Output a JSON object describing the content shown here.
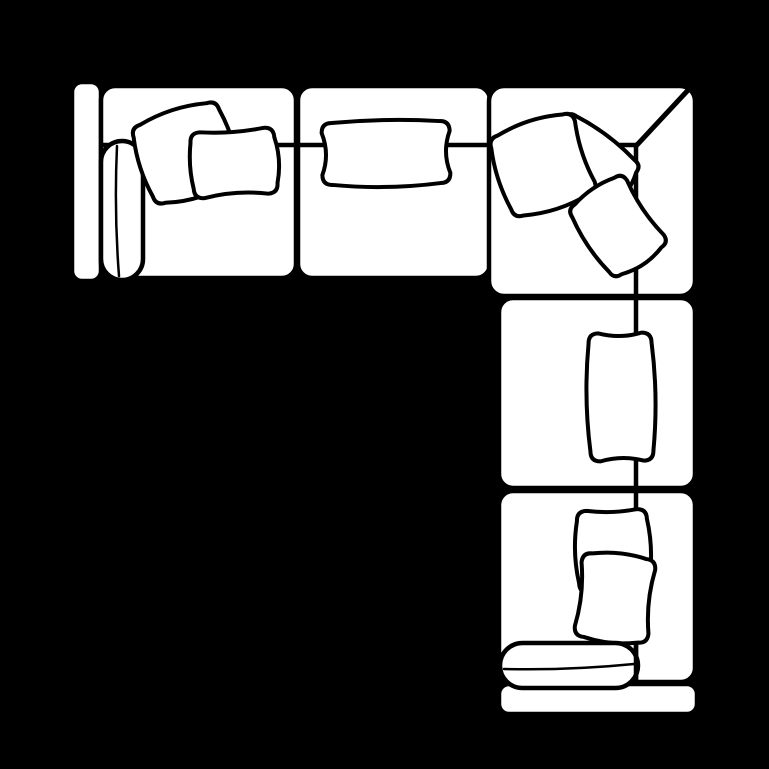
{
  "canvas": {
    "width": 769,
    "height": 769,
    "background_color": "#000000",
    "line_color": "#000000",
    "fill_color": "#ffffff"
  },
  "furniture": {
    "type": "sectional-sofa-top-view",
    "description": "L-shaped sectional sofa plan-view line drawing",
    "elements": [
      {
        "kind": "rect",
        "name": "left-armrest",
        "x": 72,
        "y": 82,
        "w": 29,
        "h": 199,
        "rx": 10,
        "sw": 4.5
      },
      {
        "kind": "rect",
        "name": "seat-section-left",
        "x": 101,
        "y": 86,
        "w": 195,
        "h": 192,
        "rx": 14,
        "sw": 4.5
      },
      {
        "kind": "rect",
        "name": "seat-section-middle",
        "x": 298,
        "y": 86,
        "w": 192,
        "h": 192,
        "rx": 14,
        "sw": 4.5
      },
      {
        "kind": "rect",
        "name": "corner-section",
        "x": 489,
        "y": 86,
        "w": 206,
        "h": 210,
        "rx": 15,
        "sw": 4.5
      },
      {
        "kind": "rect",
        "name": "seat-section-right-upper",
        "x": 499,
        "y": 298,
        "w": 196,
        "h": 190,
        "rx": 14,
        "sw": 4.5
      },
      {
        "kind": "rect",
        "name": "seat-section-right-lower",
        "x": 499,
        "y": 491,
        "w": 196,
        "h": 191,
        "rx": 14,
        "sw": 4.5
      },
      {
        "kind": "rect",
        "name": "bottom-armrest",
        "x": 499,
        "y": 684,
        "w": 198,
        "h": 30,
        "rx": 10,
        "sw": 4.5
      },
      {
        "kind": "line",
        "name": "backrest-seam-horizontal",
        "x1": 102,
        "y1": 145,
        "x2": 636,
        "y2": 145,
        "sw": 4.5
      },
      {
        "kind": "line",
        "name": "backrest-seam-vertical",
        "x1": 636,
        "y1": 145,
        "x2": 636,
        "y2": 682,
        "sw": 4.5
      },
      {
        "kind": "line",
        "name": "corner-diagonal-seam",
        "x1": 690,
        "y1": 88,
        "x2": 636,
        "y2": 146,
        "sw": 5
      },
      {
        "kind": "capsule",
        "name": "left-bolster-cushion",
        "x": 101,
        "y": 141,
        "w": 42,
        "h": 139,
        "sw": 4.5,
        "seam": {
          "x1": 117,
          "y1": 146,
          "x2": 119,
          "y2": 276,
          "bow": 2,
          "sw": 2.5
        }
      },
      {
        "kind": "pillow",
        "name": "throw-pillow-left-back",
        "cx": 186,
        "cy": 153,
        "w": 90,
        "h": 82,
        "rot": -18,
        "r": 10,
        "bows": [
          4,
          3,
          5,
          3
        ]
      },
      {
        "kind": "pillow",
        "name": "throw-pillow-left-front",
        "cx": 234,
        "cy": 163,
        "w": 84,
        "h": 66,
        "rot": -4,
        "r": 10,
        "bows": [
          -2,
          3,
          -3,
          2
        ]
      },
      {
        "kind": "pillow",
        "name": "lumbar-pillow-middle",
        "cx": 386,
        "cy": 153,
        "w": 128,
        "h": 62,
        "rot": -1,
        "r": 10,
        "bows": [
          2,
          -4,
          3,
          -4
        ]
      },
      {
        "kind": "pillow",
        "name": "throw-pillow-corner-middle",
        "cx": 587,
        "cy": 163,
        "w": 90,
        "h": 62,
        "rot": 37,
        "r": 9,
        "bows": [
          3,
          4,
          -3,
          3
        ]
      },
      {
        "kind": "pillow",
        "name": "throw-pillow-corner-left",
        "cx": 543,
        "cy": 165,
        "w": 88,
        "h": 84,
        "rot": -18,
        "r": 10,
        "bows": [
          4,
          -3,
          4,
          3
        ]
      },
      {
        "kind": "pillow",
        "name": "throw-pillow-corner-bottom",
        "cx": 618,
        "cy": 226,
        "w": 66,
        "h": 84,
        "rot": -34,
        "r": 9,
        "bows": [
          3,
          -3,
          4,
          3
        ]
      },
      {
        "kind": "pillow",
        "name": "lumbar-pillow-right",
        "cx": 621,
        "cy": 397,
        "w": 63,
        "h": 128,
        "rot": -1,
        "r": 10,
        "bows": [
          -3,
          3,
          -3,
          3
        ]
      },
      {
        "kind": "pillow",
        "name": "throw-pillow-bottom-back",
        "cx": 613,
        "cy": 551,
        "w": 70,
        "h": 82,
        "rot": -2,
        "r": 10,
        "bows": [
          -2,
          3,
          -2,
          3
        ]
      },
      {
        "kind": "pillow",
        "name": "throw-pillow-bottom-front",
        "cx": 615,
        "cy": 598,
        "w": 74,
        "h": 84,
        "rot": 6,
        "r": 10,
        "bows": [
          3,
          -3,
          3,
          -3
        ]
      },
      {
        "kind": "capsule",
        "name": "bottom-bolster-cushion",
        "x": 500,
        "y": 643,
        "w": 138,
        "h": 45,
        "sw": 4.5,
        "seam": {
          "x1": 504,
          "y1": 669,
          "x2": 634,
          "y2": 664,
          "bow": 2,
          "sw": 2.5
        }
      },
      {
        "kind": "line",
        "name": "backrest-seam-over-bolster",
        "x1": 636,
        "y1": 644,
        "x2": 636,
        "y2": 682,
        "sw": 4.5
      }
    ]
  }
}
